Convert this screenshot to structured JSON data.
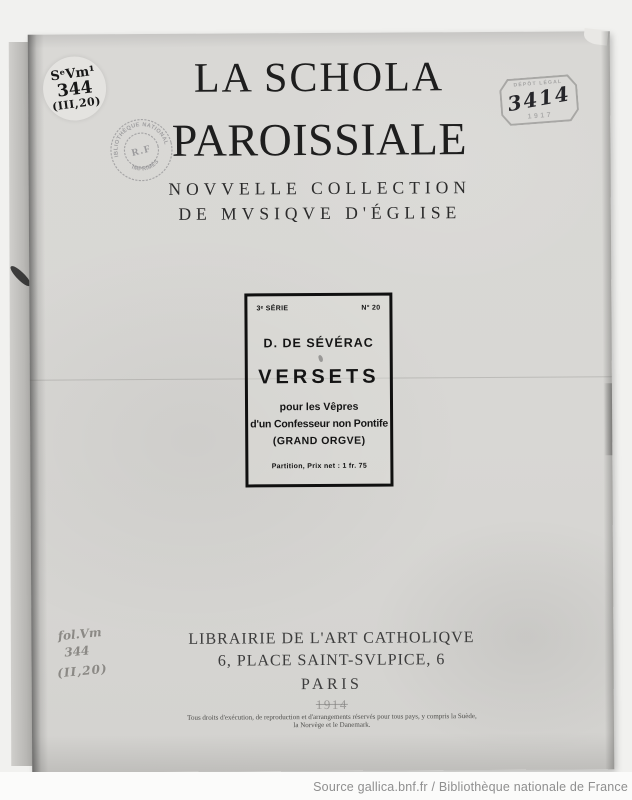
{
  "colors": {
    "paper": "#d8d7d4",
    "ink": "#1c1c1c",
    "stamp_ink": "#6f6f74",
    "pencil": "#8a8884",
    "footer_text": "#8f8f8f"
  },
  "cover": {
    "title_line1": "LA SCHOLA",
    "title_line2": "PAROISSIALE",
    "subtitle_line1": "NOVVELLE COLLECTION",
    "subtitle_line2": "DE MVSIQVE D'ÉGLISE",
    "work_box": {
      "series": "3ᵉ SÉRIE",
      "number": "N° 20",
      "composer": "D. DE SÉVÉRAC",
      "title": "VERSETS",
      "subtitle_line1": "pour les Vêpres",
      "subtitle_line2": "d'un Confesseur non Pontife",
      "subtitle_line3": "(GRAND ORGVE)",
      "price": "Partition, Prix net : 1 fr. 75"
    },
    "publisher": {
      "name": "LIBRAIRIE DE L'ART CATHOLIQVE",
      "address": "6, PLACE SAINT-SVLPICE, 6",
      "city": "PARIS",
      "year": "1914",
      "rights_line1": "Tous droits d'exécution, de reproduction et d'arrangements réservés pour tous pays, y compris la Suède,",
      "rights_line2": "la Norvège et le Danemark."
    }
  },
  "annotations": {
    "shelfmark_label": {
      "line1": "SᵉVm¹",
      "line2": "344",
      "line3": "(III,20)"
    },
    "bnf_stamp": {
      "arc_top": "BIBLIOTHÈQUE NATIONALE",
      "center": "R.F",
      "arc_bottom": "IMPRIMÉS"
    },
    "depot_stamp": {
      "label": "DÉPÔT LÉGAL",
      "number": "3414",
      "year": "1917"
    },
    "pencil_note": {
      "line1": "fol.Vm",
      "line2": "344",
      "line3": "(II,20)"
    }
  },
  "footer": {
    "source_credit": "Source gallica.bnf.fr / Bibliothèque nationale de France"
  }
}
